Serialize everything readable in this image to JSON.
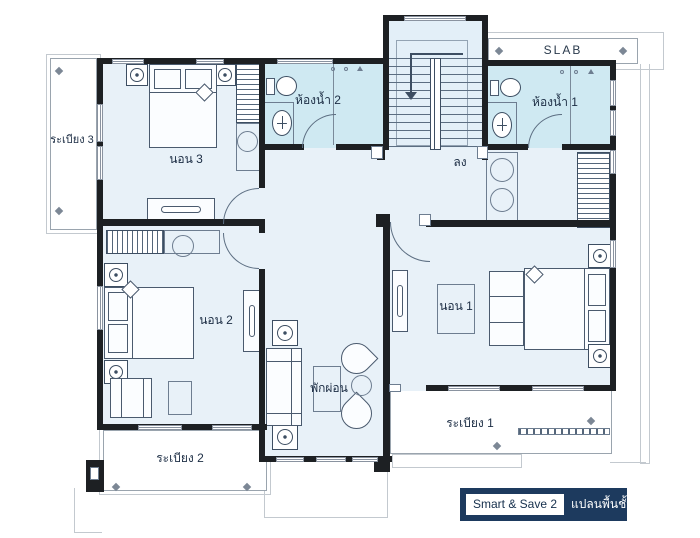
{
  "labels": {
    "balcony3": "ระเบียง 3",
    "bedroom3": "นอน 3",
    "bath2": "ห้องน้ำ 2",
    "slab": "SLAB",
    "bath1": "ห้องน้ำ 1",
    "stairs_down": "ลง",
    "bedroom2": "นอน 2",
    "bedroom1": "นอน 1",
    "living": "พักผ่อน",
    "balcony2": "ระเบียง 2",
    "balcony1": "ระเบียง 1"
  },
  "badge": {
    "brand": "Smart & Save 2",
    "plan": "แปลนพื้นชั้น 2"
  },
  "colors": {
    "room_fill": "#e8f1f8",
    "bath_fill": "#cfe9f2",
    "stair_fill": "#e3eff8",
    "wall": "#1d2023",
    "line": "#4a5a6e",
    "badge_bg": "#1d3a5e"
  }
}
